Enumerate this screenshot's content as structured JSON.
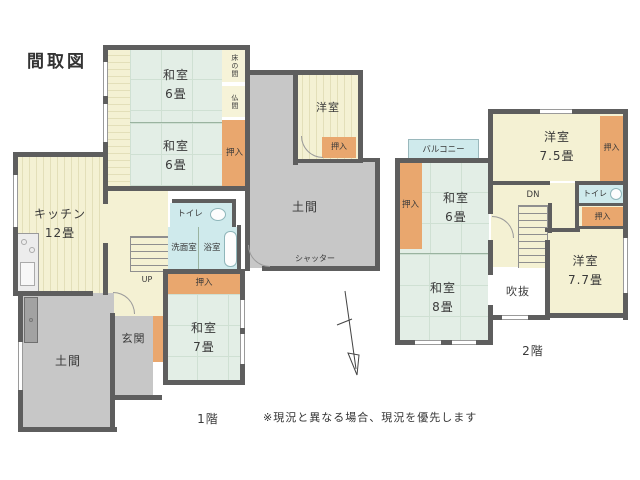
{
  "title": "間取図",
  "note": "※現況と異なる場合、現況を優先します",
  "colors": {
    "wall": "#5e5e5e",
    "tatami_room": "#e3eee6",
    "wood_room": "#f4f1d3",
    "closet": "#e9a76e",
    "doma_gray": "#c7c7c7",
    "wet_area": "#cfeaec",
    "void": "#ffffff"
  },
  "floor1": {
    "label": "1階",
    "washitsu6_top": {
      "name": "和室",
      "size": "6畳"
    },
    "washitsu6_mid": {
      "name": "和室",
      "size": "6畳"
    },
    "tokonoma": "床の間",
    "butsuma": "仏間",
    "oshiire_main": "押入",
    "yoshitsu": "洋室",
    "yoshitsu_oshiire": "押入",
    "doma_right": "土間",
    "shutter": "シャッター",
    "kitchen": {
      "name": "キッチン",
      "size": "12畳"
    },
    "toilet": "トイレ",
    "senmen": "洗面室",
    "bath": "浴室",
    "up": "UP",
    "oshiire_w7": "押入",
    "genkan": "玄関",
    "washitsu7": {
      "name": "和室",
      "size": "7畳"
    },
    "doma_left": "土間"
  },
  "floor2": {
    "label": "2階",
    "balcony": "バルコニー",
    "oshiire_left": "押入",
    "washitsu6": {
      "name": "和室",
      "size": "6畳"
    },
    "yoshitsu75": {
      "name": "洋室",
      "size": "7.5畳"
    },
    "oshiire_75": "押入",
    "dn": "DN",
    "toilet": "トイレ",
    "oshiire_toilet": "押入",
    "yoshitsu77": {
      "name": "洋室",
      "size": "7.7畳"
    },
    "washitsu8": {
      "name": "和室",
      "size": "8畳"
    },
    "fukinuke": "吹抜"
  }
}
